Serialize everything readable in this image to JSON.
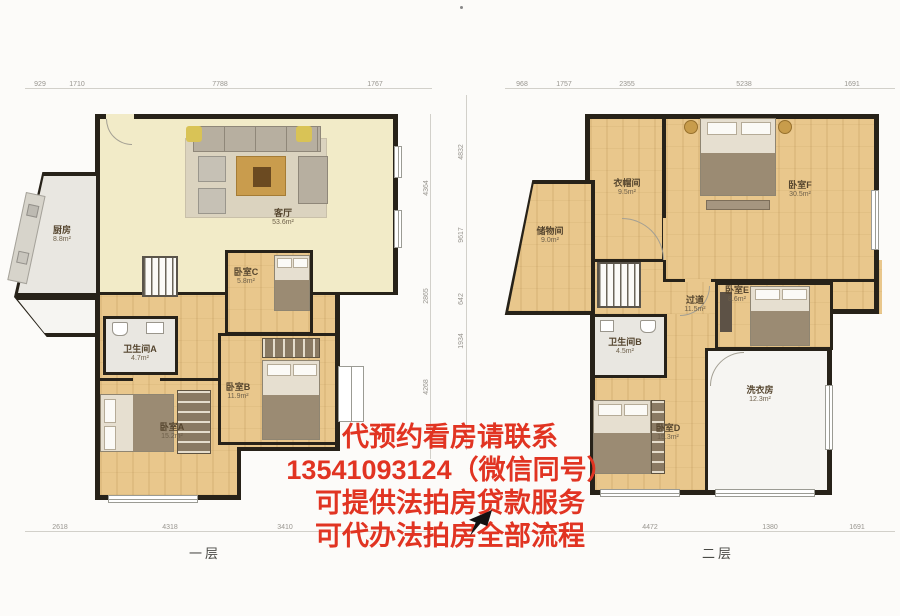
{
  "colors": {
    "watermark_red": "#e13422",
    "wood_floor": "#e9c78c",
    "cream_floor": "#f2ebc8",
    "wall": "#272219",
    "dim_text": "#98958f"
  },
  "watermark": {
    "lines": [
      "代预约看房请联系",
      "13541093124（微信同号）",
      "可提供法拍房贷款服务",
      "可代办法拍房全部流程"
    ]
  },
  "floor1": {
    "label": "一层",
    "top_dims": [
      "929",
      "1710",
      "7788",
      "1767"
    ],
    "bottom_dims": [
      "2618",
      "4318",
      "3410"
    ],
    "right_dims": [
      "4364",
      "2865",
      "4268"
    ],
    "rooms": [
      {
        "name": "厨房",
        "area": "8.8m²"
      },
      {
        "name": "客厅",
        "area": "53.6m²"
      },
      {
        "name": "卧室C",
        "area": "5.8m²"
      },
      {
        "name": "卫生间A",
        "area": "4.7m²"
      },
      {
        "name": "卧室B",
        "area": "11.9m²"
      },
      {
        "name": "卧室A",
        "area": "15.2m²"
      }
    ]
  },
  "floor2": {
    "label": "二层",
    "top_dims": [
      "968",
      "1757",
      "2355",
      "5238",
      "1691"
    ],
    "bottom_dims": [
      "4472",
      "1380",
      "1691"
    ],
    "left_dims": [
      "4832",
      "9617",
      "642",
      "1934"
    ],
    "rooms": [
      {
        "name": "衣帽间",
        "area": "9.5m²"
      },
      {
        "name": "卧室F",
        "area": "30.5m²"
      },
      {
        "name": "储物间",
        "area": "9.0m²"
      },
      {
        "name": "过道",
        "area": "11.5m²"
      },
      {
        "name": "卧室E",
        "area": "8.6m²"
      },
      {
        "name": "卫生间B",
        "area": "4.5m²"
      },
      {
        "name": "洗衣房",
        "area": "12.3m²"
      },
      {
        "name": "卧室D",
        "area": "15.3m²"
      }
    ]
  }
}
